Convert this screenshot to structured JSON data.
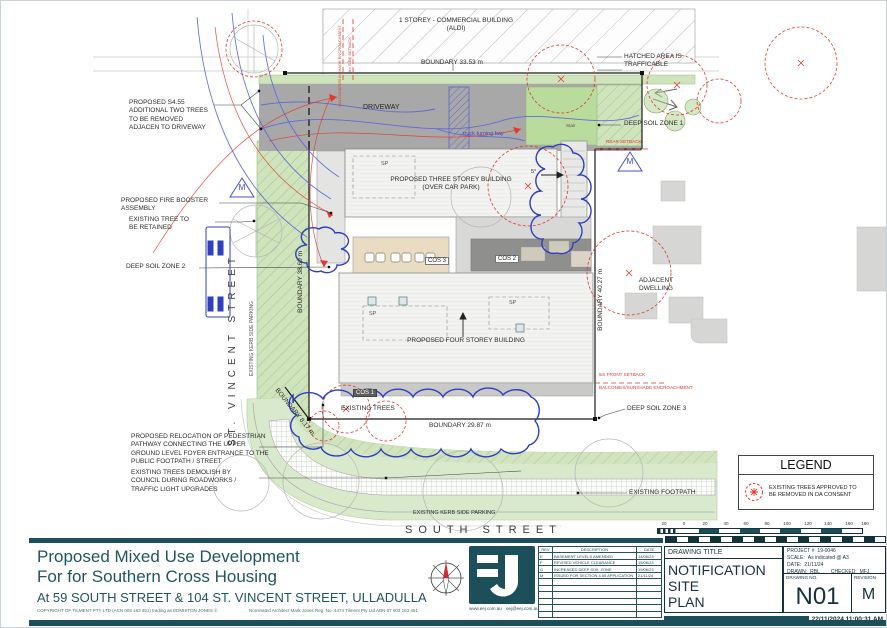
{
  "plan": {
    "aldi_label": "1 STOREY - COMMERCIAL BUILDING\n(ALDI)",
    "boundary_top": "BOUNDARY   33.53 m",
    "hatched_area": "HATCHED AREA IS\nTRAFFICABLE",
    "deep_soil_1": "DEEP SOIL ZONE 1",
    "rear_setback": "REAR SETBACK",
    "driveway": "DRIVEWAY",
    "truck_turning_bay": "truck turning bay",
    "stair": "Stair",
    "proposed_s455_note": "PROPOSED S4.55\nADDITIONAL TWO TREES\nTO BE REMOVED\nADJACEN TO DRIVEWAY",
    "fire_booster_note": "PROPOSED FIRE BOOSTER\nASSEMBLY",
    "existing_tree_retained": "EXISTING TREE TO\nBE RETAINED",
    "deep_soil_2": "DEEP SOIL ZONE 2",
    "three_storey": "PROPOSED THREE STOREY BUILDING\n(OVER CAR PARK)",
    "four_storey": "PROPOSED FOUR STOREY BUILDING",
    "cos1": "COS 1",
    "cos2": "COS 2",
    "cos3": "COS 3",
    "sp": "SP",
    "deg5": "5°",
    "m_symbol": "M",
    "existing_trees": "EXISTING TREES",
    "boundary_left_v": "BOUNDARY   38.60 m",
    "boundary_right_v": "BOUNDARY   40.27 m",
    "boundary_bottom": "BOUNDARY   29.87 m",
    "boundary_diag": "BOUNDARY  8.17 m",
    "st_vincent_street": "ST. VINCENT STREET",
    "existing_kerb_left_v": "EXISTING KERB SIDE PARKING",
    "adjacent_dwelling": "ADJACENT\nDWELLING",
    "front_setback": "5m FRONT SETBACK",
    "balconies_encroachment": "BALCONIES/SUNSHADE ENCROACHMENT",
    "side_setback_v": "3m SIDE SETBACK",
    "deep_soil_3": "DEEP SOIL ZONE 3",
    "pedestrian_note": "PROPOSED RELOCATION OF PEDESTRIAN\nPATHWAY CONNECTING THE UPPER\nGROUND LEVEL FOYER ENTRANCE TO THE\nPUBLIC FOOTPATH / STREET",
    "trees_demolish_note": "EXISTING TREES DEMOLISH BY\nCOUNCIL DURING ROADWORKS /\nTRAFFIC LIGHT UPGRADES",
    "existing_footpath": "EXISTING FOOTPATH",
    "existing_kerb_bottom": "EXISTING KERB SIDE PARKING",
    "south_street": "SOUTH STREET"
  },
  "legend": {
    "title": "LEGEND",
    "item": "EXISTING TREES APPROVED TO\nBE REMOVED IN DA CONSENT"
  },
  "scalebar": {
    "ticks": [
      "20",
      "0",
      "20",
      "40",
      "60",
      "80",
      "100",
      "120",
      "140",
      "160",
      "180"
    ]
  },
  "titleblock": {
    "line1": "Proposed Mixed Use Development",
    "line2": "For for Southern Cross Housing",
    "line3": "At 59 SOUTH STREET & 104 ST. VINCENT STREET, ULLADULLA",
    "copyright": "COPYRIGHT OF TILMENT PTY LTD (ACN 003 163 451) trading as EDMISTON JONES ©",
    "architect": "Nominated Architect Mark Jones Reg. No. 4474 Tilment Pty Ltd ABN 67 003 163 451",
    "website": "www.eej.com.au",
    "email": "eej@eej.com.au",
    "rev_table": {
      "headers": {
        "rev": "REV",
        "description": "DESCRIPTION",
        "date": "DATE"
      },
      "rows": [
        {
          "rev": "E",
          "description": "BASEMENT LEVELS AMENDED",
          "date": "14/06/23"
        },
        {
          "rev": "F",
          "description": "REVISED VEHICLE CLEARANCE",
          "date": "15/06/23"
        },
        {
          "rev": "G",
          "description": "INCREASED DEEP SOIL ZONE",
          "date": "19/06/23"
        },
        {
          "rev": "M",
          "description": "ISSUED FOR SECTION 4.55 APPLICATION",
          "date": "21/11/24"
        }
      ]
    },
    "drawing_title_label": "DRAWING TITLE",
    "drawing_title": "NOTIFICATION SITE\nPLAN",
    "project_label": "PROJECT #",
    "project": "19-0046",
    "scale_label": "SCALE:",
    "scale": "As indicated @ A3",
    "date_label": "DATE:",
    "date": "21/11/24",
    "drawn_label": "DRAWN:",
    "drawn": "RBL",
    "checked_label": "CHECKED:",
    "checked": "MFJ",
    "drawing_no_label": "DRAWING NO.",
    "drawing_no": "N01",
    "revision_label": "REVISION",
    "revision": "M",
    "timestamp": "22/11/2024 11:00:31 AM"
  },
  "colors": {
    "accent_teal": "#1d4f5a",
    "annotation_red": "#e0392e",
    "annotation_blue": "#3947c6",
    "site_green": "#cfe3bd",
    "driveway_gray": "#a8a8a8"
  }
}
